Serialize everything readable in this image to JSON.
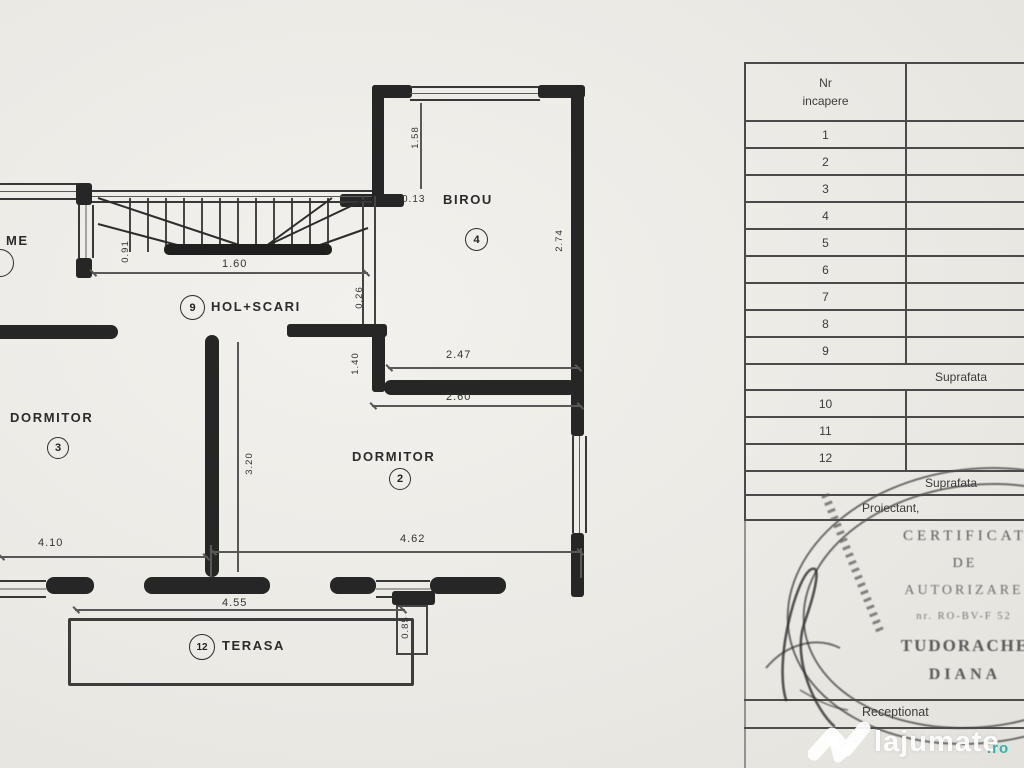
{
  "plan": {
    "rooms": {
      "birou": {
        "label": "BIROU",
        "number": "4"
      },
      "hol_scari": {
        "label": "HOL+SCARI",
        "number": "9"
      },
      "dormitor3": {
        "label": "DORMITOR",
        "number": "3"
      },
      "dormitor2": {
        "label": "DORMITOR",
        "number": "2"
      },
      "terasa": {
        "label": "TERASA",
        "number": "12"
      },
      "partial_left": {
        "label": "ME"
      }
    },
    "dims": {
      "d013": "0.13",
      "d158": "1.58",
      "d160": "1.60",
      "d091": "0.91",
      "d026": "0.26",
      "d247": "2.47",
      "d260": "2.60",
      "d140": "1.40",
      "d274": "2.74",
      "d320": "3.20",
      "d410": "4.10",
      "d462": "4.62",
      "d455": "4.55",
      "d085": "0.85"
    }
  },
  "table": {
    "header": {
      "col1_line1": "Nr",
      "col1_line2": "incapere",
      "col2": "Denumire"
    },
    "rows": [
      {
        "nr": "1",
        "name": "living+"
      },
      {
        "nr": "2",
        "name": "dorm"
      },
      {
        "nr": "3",
        "name": "dorm"
      },
      {
        "nr": "4",
        "name": "bir"
      },
      {
        "nr": "5",
        "name": "buca"
      },
      {
        "nr": "6",
        "name": "ba"
      },
      {
        "nr": "7",
        "name": "ba"
      },
      {
        "nr": "8",
        "name": "ho"
      },
      {
        "nr": "9",
        "name": "hol+s"
      },
      {
        "nr": "10",
        "name": "tera"
      },
      {
        "nr": "11",
        "name": "tera"
      },
      {
        "nr": "12",
        "name": "tera"
      }
    ],
    "suprafata1": "Suprafata",
    "suprafata2": "Suprafata",
    "proiectant": "Proiectant,",
    "receptionat": "Receptionat"
  },
  "stamp": {
    "title1": "CERTIFICAT",
    "title2": "DE",
    "title3": "AUTORIZARE",
    "serial": "nr. RO-BV-F 52",
    "name_line1": "TUDORACHE",
    "name_line2": "DIANA"
  },
  "watermark": {
    "brand": "lajumate",
    "tld": ".ro",
    "teal": "#2db5ab"
  }
}
